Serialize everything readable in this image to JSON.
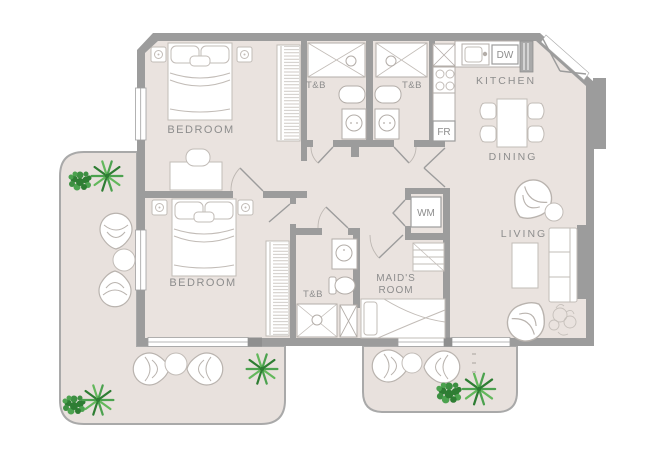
{
  "plan": {
    "labels": {
      "bedroom1": "BEDROOM",
      "bedroom2": "BEDROOM",
      "tb1": "T&B",
      "tb2": "T&B",
      "tb3": "T&B",
      "kitchen": "KITCHEN",
      "dining": "DINING",
      "living": "LIVING",
      "maids_room_line1": "MAID'S",
      "maids_room_line2": "ROOM",
      "wm": "WM",
      "fr": "FR",
      "dw": "DW"
    },
    "colors": {
      "wall": "#9c9c9c",
      "floor": "#eae3df",
      "terrace_floor": "#e8e1dd",
      "terrace_outline": "#a9a9a9",
      "furniture_line": "#c2bcb7",
      "label_text": "#8d8d8d",
      "plant_dark": "#2e7d33",
      "plant_mid": "#3d8f42",
      "plant_light": "#4ca24f"
    }
  }
}
